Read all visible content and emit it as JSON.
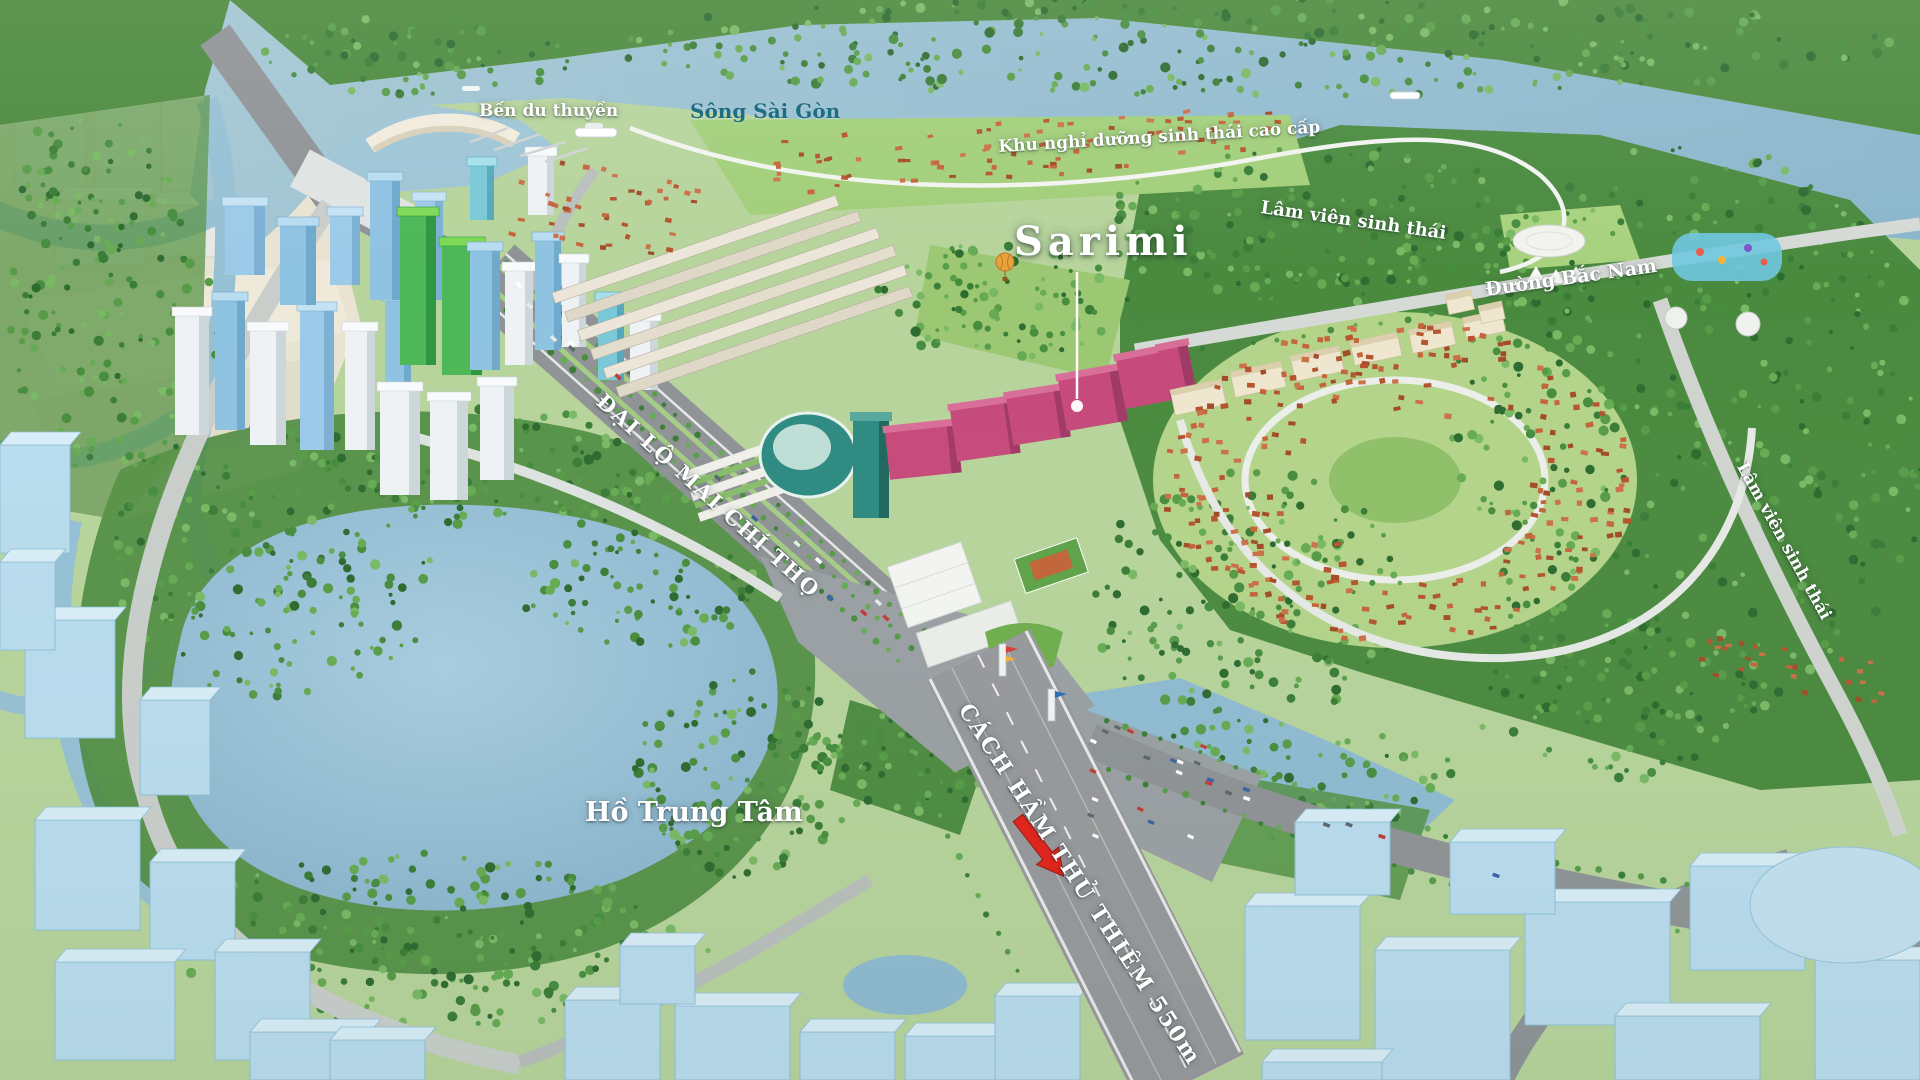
{
  "title": "Thủ Thiêm Sala masterplan aerial map",
  "labels": {
    "marina": "Bến du thuyền",
    "river": "Sông Sài Gòn",
    "eco_resort": "Khu nghỉ dưỡng sinh thái cao cấp",
    "eco_forest_park_north": "Lâm viên sinh thái",
    "project_name": "Sarimi",
    "north_south_road": "Đường Bắc Nam",
    "boulevard": "ĐẠI LỘ MAI CHÍ THỌ",
    "eco_forest_park_east": "Lâm viên sinh thái",
    "central_lake": "Hồ Trung Tâm",
    "tunnel_distance": "CÁCH HẦM THỦ THIÊM 550m"
  },
  "icons": {
    "project_pointer": "location-pointer-line-with-dot",
    "direction_arrow": "red-arrow-down-right"
  },
  "colors": {
    "river_water": "#95bdd2",
    "lake_water": "#8fbbd3",
    "forest_green": "#3f7f38",
    "lawn_green": "#a9d07e",
    "road_gray": "#8f9396",
    "highlight_building_pink": "#c64a7b",
    "ghost_building_blue": "#b9dcee",
    "label_white": "#ffffff",
    "label_teal": "#1d6e83",
    "arrow_red": "#e2261a"
  }
}
